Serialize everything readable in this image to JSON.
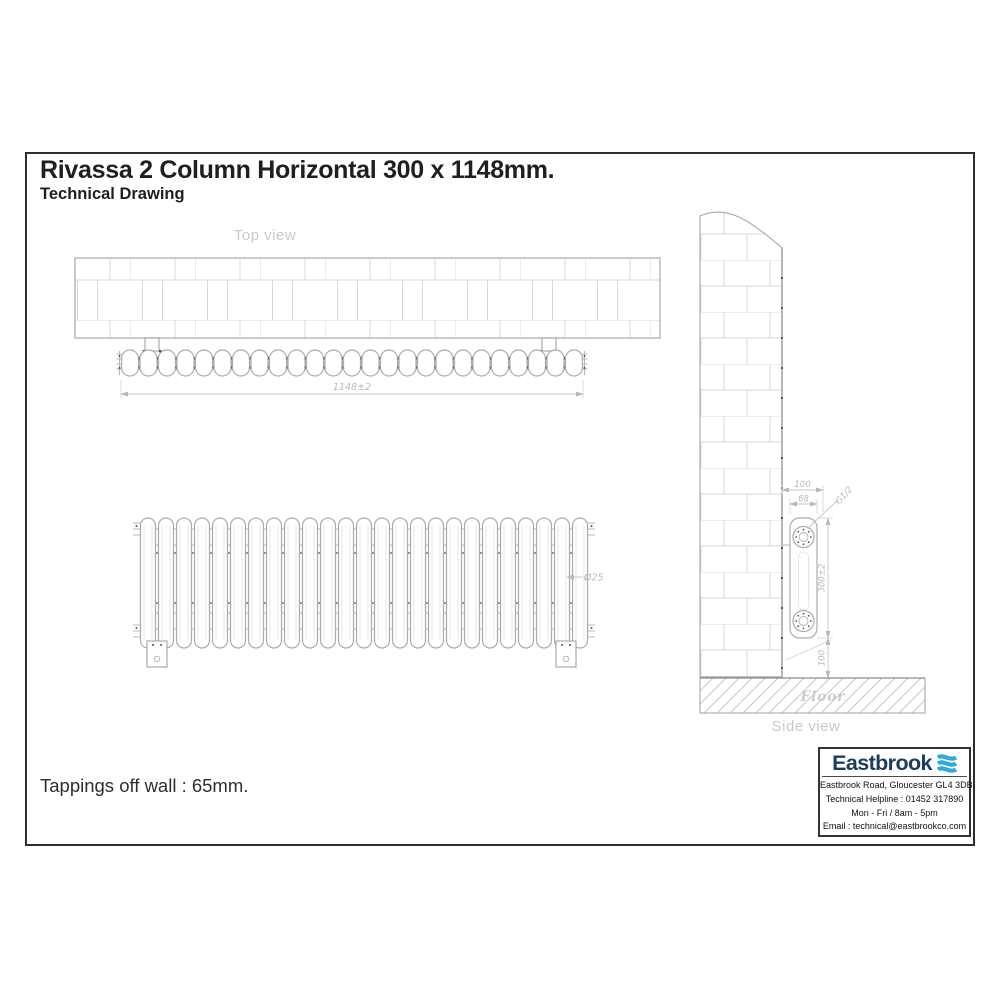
{
  "title": {
    "main": "Rivassa 2 Column Horizontal 300 x 1148mm.",
    "sub": "Technical Drawing"
  },
  "notes": {
    "tappings": "Tappings off wall : 65mm."
  },
  "views": {
    "top": {
      "label": "Top view",
      "dim_width": "1148±2"
    },
    "front": {
      "dim_tube": "Ø25"
    },
    "side": {
      "label": "Side view",
      "floor": "Floor",
      "dim_depth": "100",
      "dim_column_depth": "68",
      "dim_thread": "G1/2",
      "dim_height": "300±2",
      "dim_floor_clearance": "100"
    }
  },
  "drawing": {
    "column_count": 25,
    "line_color": "#ababab",
    "dim_text_color": "#b9b9b9",
    "label_color": "#c9c9c9"
  },
  "brand": {
    "name": "Eastbrook",
    "address": "Eastbrook Road, Gloucester GL4 3DB",
    "helpline": "Technical Helpline : 01452 317890",
    "hours": "Mon - Fri / 8am - 5pm",
    "email": "Email : technical@eastbrookco.com",
    "navy": "#1e3c60",
    "blue": "#2fa9de"
  }
}
